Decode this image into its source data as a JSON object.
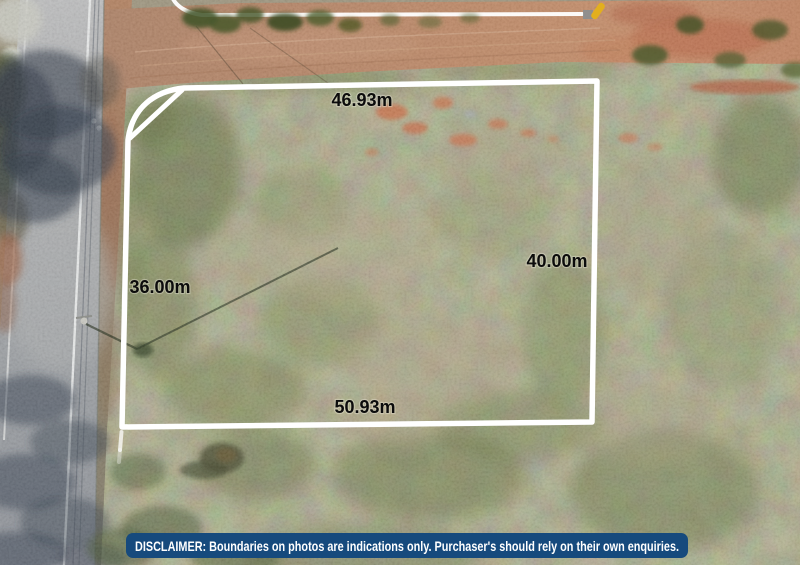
{
  "scene": {
    "type": "aerial-property-boundary-photo",
    "measurements": {
      "top": "46.93m",
      "right": "40.00m",
      "left": "36.00m",
      "bottom": "50.93m"
    },
    "disclaimer": {
      "text": "DISCLAIMER: Boundaries on photos are indications only. Purchaser's should rely on their own enquiries."
    },
    "colors": {
      "boundary_line": "#ffffff",
      "label_text": "#0c0c0c",
      "disclaimer_bg": "#164a7d",
      "disclaimer_text": "#ffffff",
      "marker_yellow": "#e2af1e"
    }
  }
}
